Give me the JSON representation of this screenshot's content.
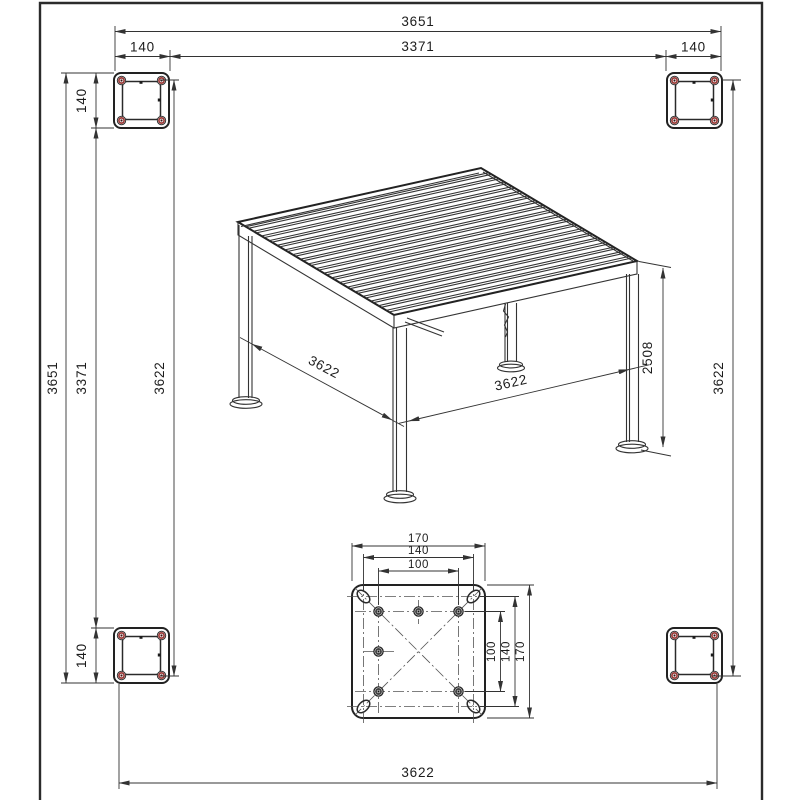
{
  "drawing": {
    "type": "technical-cad-drawing",
    "subject": "louvered pergola dimensioned views",
    "colors": {
      "line": "#333333",
      "heavy_line": "#222222",
      "bolt_hole_red": "#9c3b38",
      "background": "#ffffff"
    },
    "labels": {
      "top": {
        "overall": "3651",
        "inner": "3371",
        "left_offset": "140",
        "right_offset": "140"
      },
      "left": {
        "overall": "3651",
        "inner": "3371",
        "roof": "3622",
        "post_top": "140",
        "post_bottom": "140"
      },
      "right": {
        "roof": "3622"
      },
      "bottom": {
        "roof": "3622"
      },
      "iso": {
        "depth": "3622",
        "width": "3622",
        "height": "2508"
      },
      "plate": {
        "w_outer": "170",
        "w_mid": "140",
        "w_inner": "100",
        "h_outer": "170",
        "h_mid": "140",
        "h_inner": "100"
      }
    }
  }
}
